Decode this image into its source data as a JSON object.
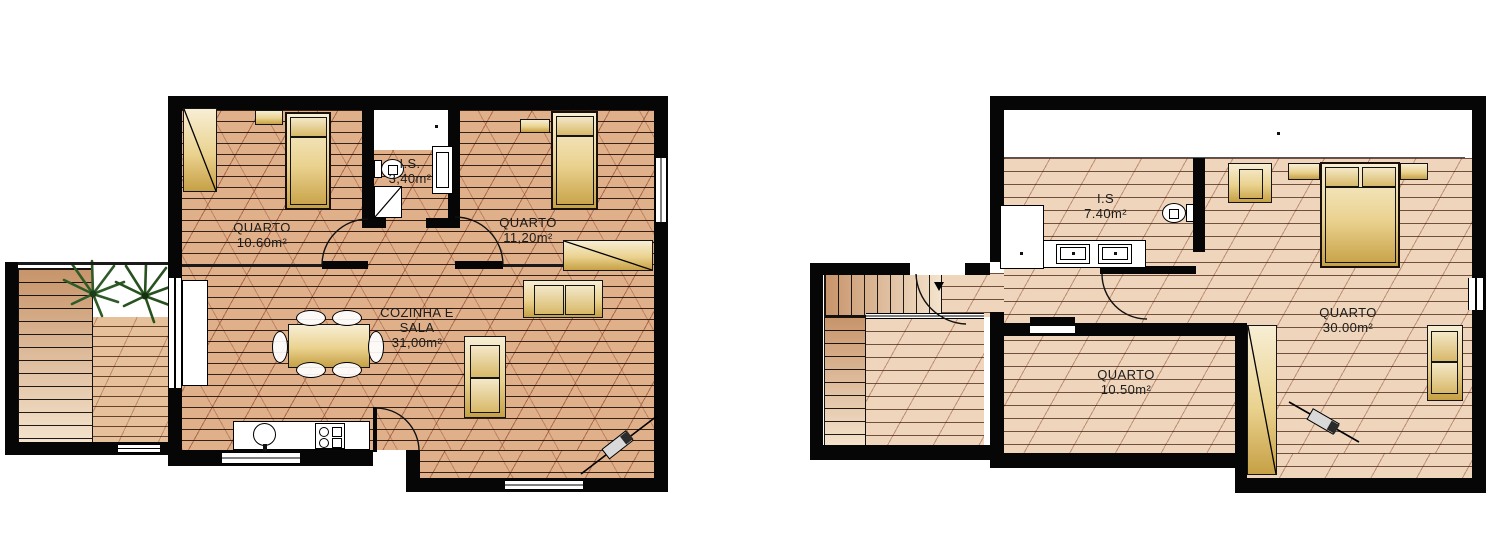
{
  "drawing": {
    "type": "architectural floor plans",
    "palette": {
      "wall": "#060606",
      "floor_left_plan": "#e0b08a",
      "floor_right_plan": "#eed5bb",
      "deck": "#e5c09a",
      "furniture_gold": "#c6a045",
      "furniture_light": "#f7eed4",
      "plant_green": "#2e5b28",
      "background": "#ffffff"
    }
  },
  "plans": [
    {
      "id": "ground-floor",
      "rooms": {
        "bedroom1": {
          "label": "QUARTO",
          "area": "10.60m²"
        },
        "bathroom": {
          "label": "I.S.",
          "area": "3,40m²"
        },
        "bedroom2": {
          "label": "QUARTO",
          "area": "11,20m²"
        },
        "living": {
          "label1": "COZINHA E",
          "label2": "SALA",
          "area": "31,00m²"
        }
      }
    },
    {
      "id": "upper-floor",
      "rooms": {
        "bathroom": {
          "label": "I.S",
          "area": "7.40m²"
        },
        "bedroom_master": {
          "label": "QUARTO",
          "area": "30.00m²"
        },
        "bedroom_small": {
          "label": "QUARTO",
          "area": "10.50m²"
        }
      }
    }
  ]
}
